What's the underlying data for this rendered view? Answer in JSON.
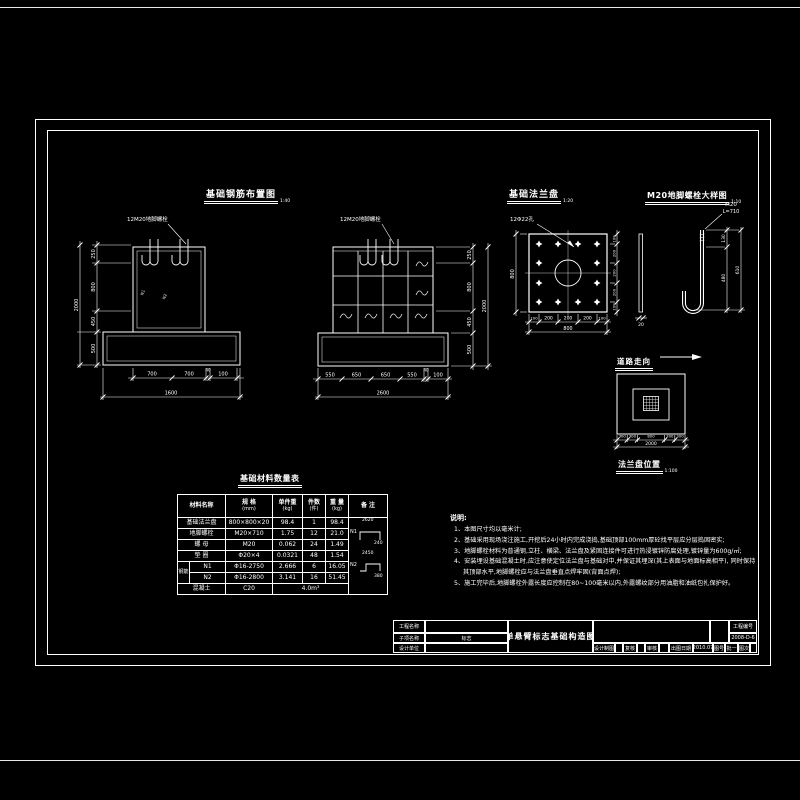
{
  "fig1": {
    "title": "基础钢筋布置图",
    "scale": "1:40",
    "bolt_label": "12M20地脚螺栓",
    "mark1": "N1",
    "mark2": "N2",
    "dims_left": [
      "250",
      "800",
      "450",
      "500"
    ],
    "dim_left_total": "2000",
    "dims_bottom": [
      "700",
      "700",
      "40",
      "100"
    ],
    "dim_bottom_total": "1600"
  },
  "fig2": {
    "bolt_label": "12M20地脚螺栓",
    "dims_right": [
      "250",
      "800",
      "450",
      "500"
    ],
    "dim_right_total": "2000",
    "dims_bottom": [
      "550",
      "650",
      "650",
      "550",
      "40",
      "100"
    ],
    "dim_bottom_total": "2600"
  },
  "fig3": {
    "title": "基础法兰盘",
    "scale": "1:20",
    "hole_label": "12Φ22孔",
    "dim_left_total": "800",
    "dims_bottom": [
      "100",
      "200",
      "200",
      "200",
      "100"
    ],
    "dim_bottom_total": "800",
    "dims_right": [
      "100",
      "200",
      "200",
      "200",
      "100"
    ],
    "thickness": "20"
  },
  "fig4": {
    "title": "M20地脚螺栓大样图",
    "scale": "1:10",
    "spec": "M20",
    "length": "L=710",
    "dims": [
      "130",
      "480"
    ],
    "dim_total": "610"
  },
  "fig5": {
    "road_label": "道路走向",
    "title": "法兰盘位置",
    "scale": "1:100",
    "dims_bottom": [
      "300",
      "300",
      "800",
      "300",
      "300"
    ],
    "dim_bottom_total": "2000"
  },
  "table": {
    "title": "基础材料数量表",
    "headers": {
      "c1": "材料名称",
      "c2": "规  格",
      "c2u": "(mm)",
      "c3": "单件重",
      "c3u": "(kg)",
      "c4": "件数",
      "c4u": "(件)",
      "c5": "重 量",
      "c5u": "(kg)",
      "c6": "备  注"
    },
    "rows": [
      {
        "name": "基础法兰盘",
        "spec": "800×800×20",
        "unit": "98.4",
        "qty": "1",
        "weight": "98.4"
      },
      {
        "name": "地脚螺栓",
        "spec": "M20×710",
        "unit": "1.75",
        "qty": "12",
        "weight": "21.0"
      },
      {
        "name": "螺  母",
        "spec": "M20",
        "unit": "0.062",
        "qty": "24",
        "weight": "1.49"
      },
      {
        "name": "垫  圈",
        "spec": "Φ20×4",
        "unit": "0.0321",
        "qty": "48",
        "weight": "1.54"
      }
    ],
    "group_label": "钢筋",
    "rebar_rows": [
      {
        "name": "N1",
        "spec": "Φ16-2750",
        "unit": "2.666",
        "qty": "6",
        "weight": "16.05"
      },
      {
        "name": "N2",
        "spec": "Φ16-2800",
        "unit": "3.141",
        "qty": "16",
        "weight": "51.45"
      }
    ],
    "concrete": {
      "name": "混凝土",
      "spec": "C20",
      "volume": "4.0m³"
    },
    "remark_n1": {
      "label": "N1",
      "d1": "2620",
      "d2": "240"
    },
    "remark_n2": {
      "label": "N2",
      "d1": "2450",
      "d2": "380"
    }
  },
  "notes": {
    "title": "说明:",
    "items": [
      "1、本图尺寸均以毫米计;",
      "2、基础采用现场浇注施工,开挖后24小时内完成浇捣,基础顶部100mm厚砼找平层应分层捣固密实;",
      "3、地脚螺栓材料为普通钢,立柱、横梁、法兰盘及紧固连接件可进行热浸镀锌防腐处理,镀锌量为600g/㎡;",
      "4、安装埋设基础混凝土时,应注意使定位法兰盘与基础对中,并保证其埋深(其上表面与地面标高相平), 同时保持其顶部水平,地脚螺栓应与法兰盘垂直点焊牢固(背面点焊);",
      "5、施工完毕后,地脚螺栓外露长度应控制在80~100毫米以内,外露螺纹部分用油脂和油纸包扎保护好。"
    ]
  },
  "titleblock": {
    "project_label": "工程名称",
    "subitem_label": "子项名称",
    "unit_label": "设计单位",
    "subitem_value": "标志",
    "drawing_title": "单悬臂标志基础构造图",
    "design_label": "设计制图",
    "check_label": "复核",
    "review_label": "审核",
    "date_label": "出图日期",
    "date_value": "2010.07",
    "no_label": "图号",
    "no_value": "批一",
    "sheet_label": "图次",
    "project_no_label": "工程编号",
    "project_no_value": "2008-D-6"
  }
}
